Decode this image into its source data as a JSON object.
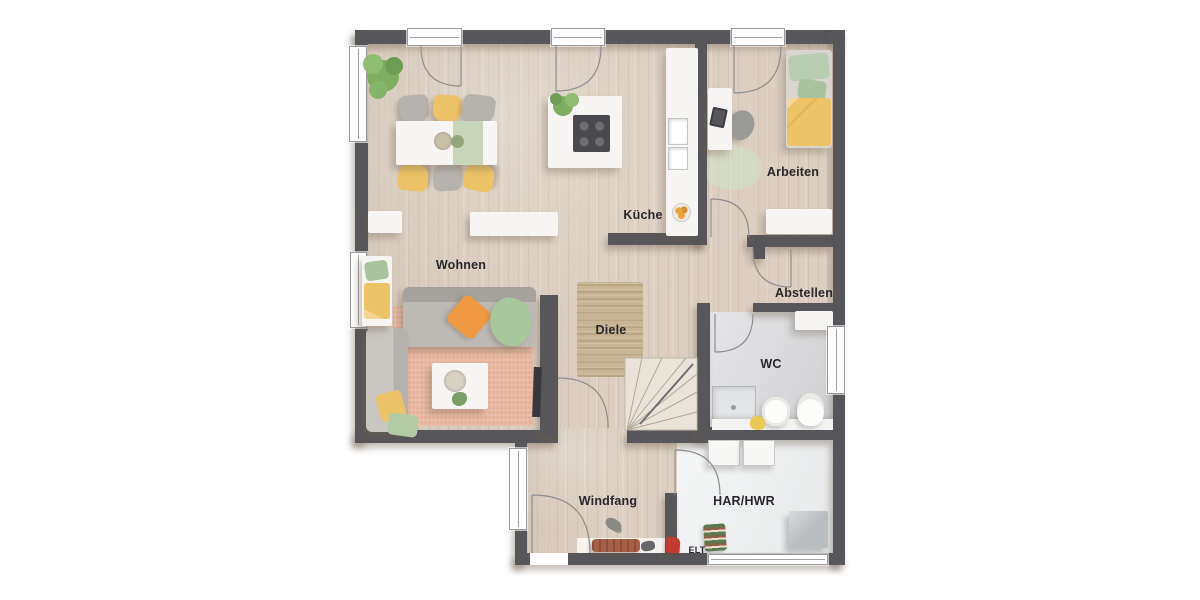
{
  "floorplan": {
    "labels": {
      "wohnen": "Wohnen",
      "kueche": "Küche",
      "arbeiten": "Arbeiten",
      "abstellen": "Abstellen",
      "diele": "Diele",
      "wc": "WC",
      "windfang": "Windfang",
      "har_hwr": "HAR/HWR",
      "elt": "ELT"
    },
    "colors": {
      "wall": "#57565a",
      "floor-wood": "#d9cbbc",
      "floor-wc": "#d7d8da",
      "floor-hwr": "#edeff0",
      "accent-yellow": "#edc368",
      "accent-orange": "#ef9a42",
      "accent-green": "#a9c79c",
      "rug-salmon": "#e9b79f",
      "rug-jute": "#c9b493"
    }
  }
}
